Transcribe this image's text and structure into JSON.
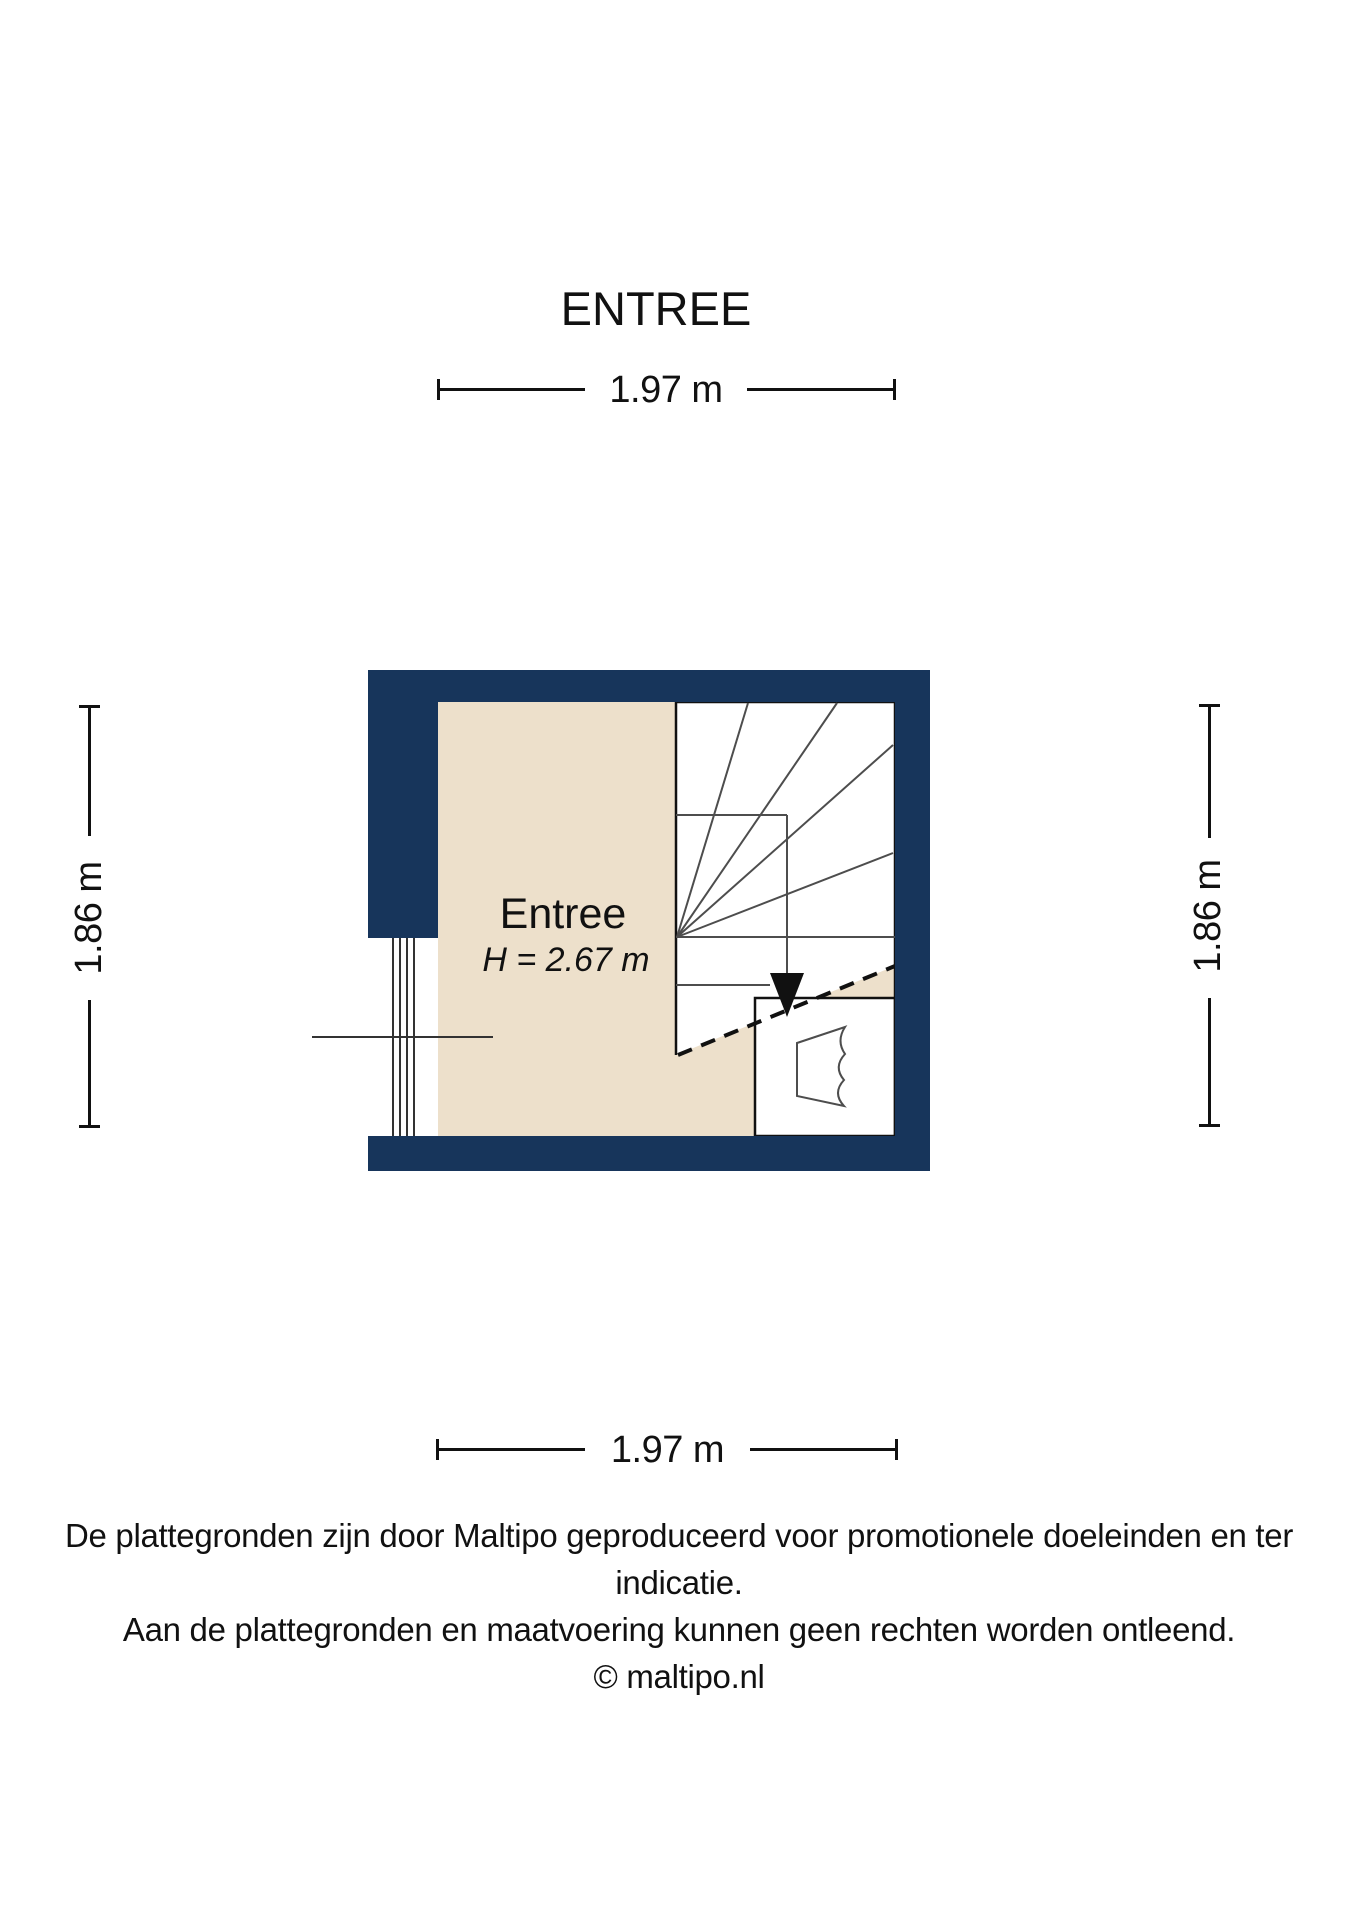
{
  "title": "ENTREE",
  "room": {
    "name": "Entree",
    "height_label": "H = 2.67 m"
  },
  "dimensions": {
    "top": "1.97 m",
    "bottom": "1.97 m",
    "left": "1.86 m",
    "right": "1.86 m"
  },
  "disclaimer": {
    "line1": "De plattegronden zijn door Maltipo geproduceerd voor promotionele doeleinden en ter indicatie.",
    "line2": "Aan de plattegronden en maatvoering kunnen geen rechten worden ontleend.",
    "line3": "© maltipo.nl"
  },
  "colors": {
    "wall": "#17355B",
    "floor": "#EDE0CB",
    "line": "#4d4d4d"
  }
}
